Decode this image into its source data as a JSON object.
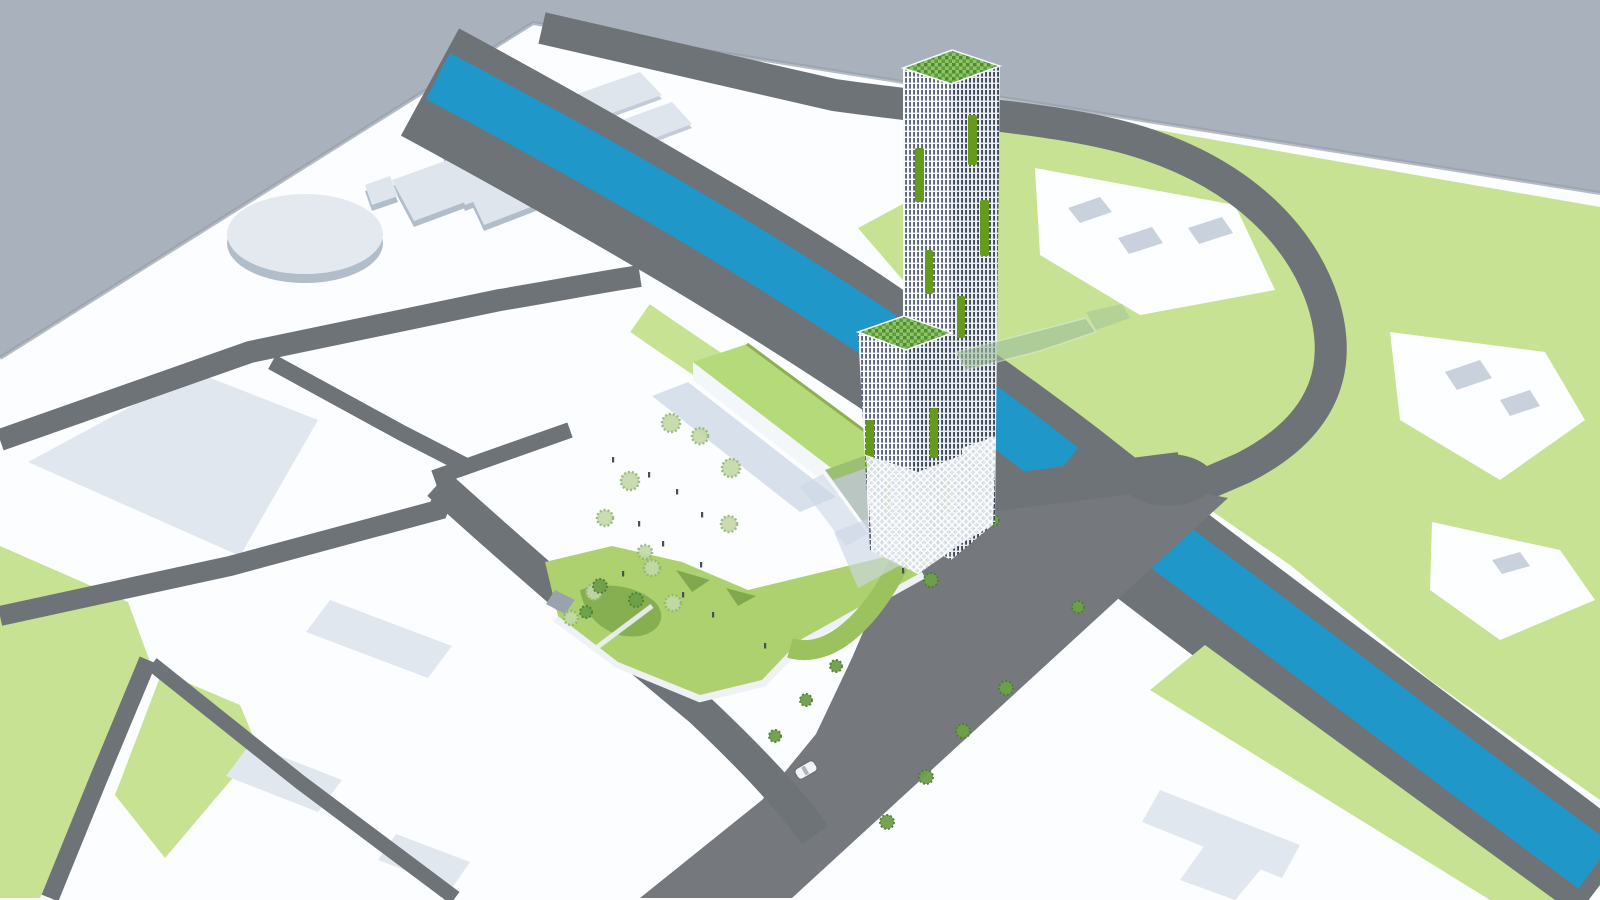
{
  "scene": {
    "type": "3d-architectural-site-plan-render",
    "elements": {
      "sky": "sky-backdrop",
      "ground": "city-model-ground-plane",
      "river": "canal",
      "roads": "street-network",
      "parks": "green-park-areas",
      "tower": "high-rise-tower-with-green-terraces",
      "podium": "green-roof-podium-building",
      "landform": "green-landform-ramp-building",
      "footbridge": "glass-footbridge",
      "plaza": "public-plaza",
      "trees": "tree-icon",
      "people": "pedestrian-figures",
      "car": "car-icon"
    }
  },
  "colors": {
    "sky": "#a9b1bd",
    "ground": "#fcfdfe",
    "edge_shade": "#97a0ab",
    "road": "#6e7378",
    "road2": "#75797d",
    "bank": "#8e969e",
    "river": "#1f97c9",
    "lawn": "#c7e292",
    "park_white": "#fdfeff",
    "footprint": "#dfe5ec",
    "footprint_side": "#c2cbd7",
    "footprint_small": "#c9d2dc",
    "block_large": "#e1e7ee",
    "oval_top": "#e4e9f0",
    "oval_side": "#b2bdca",
    "shadow": "#ccd7e4",
    "podium_roof": "#b5da79",
    "podium_edge": "#8fae54",
    "podium_wall": "#f4f7f9",
    "glass_block": "#b9c6c2",
    "glass_top": "#9cc073",
    "ramp_green": "#9cc25f",
    "ramp_white": "#eef2f6",
    "hill_green": "#aed16f",
    "hill_green_dark": "#7fa94c",
    "rock": "#9aa3ad",
    "tree_pale": "#c3d9a8",
    "tree_pale_dark": "#96b573",
    "tree_dark": "#6da04a",
    "tree_dark2": "#4f8030",
    "people": "#4a4f57",
    "car_body": "#f3f5f7",
    "car_line": "#6a7076",
    "car_glass": "#9aa4ad",
    "bridge_glass": "#9fbf9b",
    "bridge_edge": "#d6e6d2",
    "facade_bg_l": "#f6f8fa",
    "facade_stripe_l": "#4a5466",
    "facade_bg_r": "#e9edf1",
    "facade_stripe_r": "#3e4757",
    "roof_g1": "#8fc468",
    "roof_g2": "#4f8d33",
    "roof_g3": "#5e9c3c",
    "lattice_bg": "#dde4ea",
    "lattice_line": "#ffffff",
    "accent_green": "#669a1d"
  }
}
